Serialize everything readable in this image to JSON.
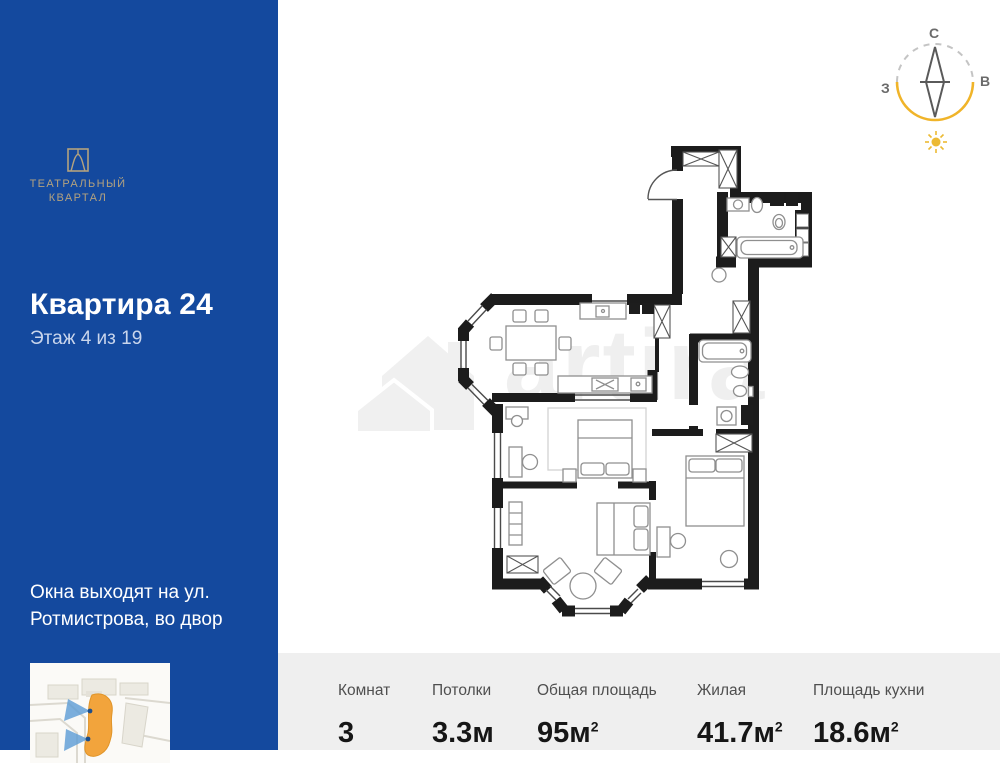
{
  "sidebar": {
    "bg_color": "#14499e",
    "logo": {
      "line1": "ТЕАТРАЛЬНЫЙ",
      "line2": "КВАРТАЛ",
      "color": "#b3a27f"
    },
    "title": "Квартира 24",
    "subtitle": "Этаж 4 из 19",
    "windows_note": "Окна выходят на ул. Ротмистрова, во двор"
  },
  "compass": {
    "north": "С",
    "west": "З",
    "east": "В",
    "arc_color": "#f0b429",
    "needle_color": "#5a5a5a"
  },
  "watermark": {
    "text": "artira"
  },
  "floorplan": {
    "wall_color": "#1c1c1c",
    "furniture_color": "#8f8f8f"
  },
  "map": {
    "highlight_color": "#f2a43c",
    "view_cone_color": "#5b9bd5"
  },
  "stats": {
    "bg_color": "#efefef",
    "items": [
      {
        "label": "Комнат",
        "value": "3",
        "sup": ""
      },
      {
        "label": "Потолки",
        "value": "3.3м",
        "sup": ""
      },
      {
        "label": "Общая площадь",
        "value": "95м",
        "sup": "2"
      },
      {
        "label": "Жилая",
        "value": "41.7м",
        "sup": "2"
      },
      {
        "label": "Площадь кухни",
        "value": "18.6м",
        "sup": "2"
      }
    ]
  }
}
